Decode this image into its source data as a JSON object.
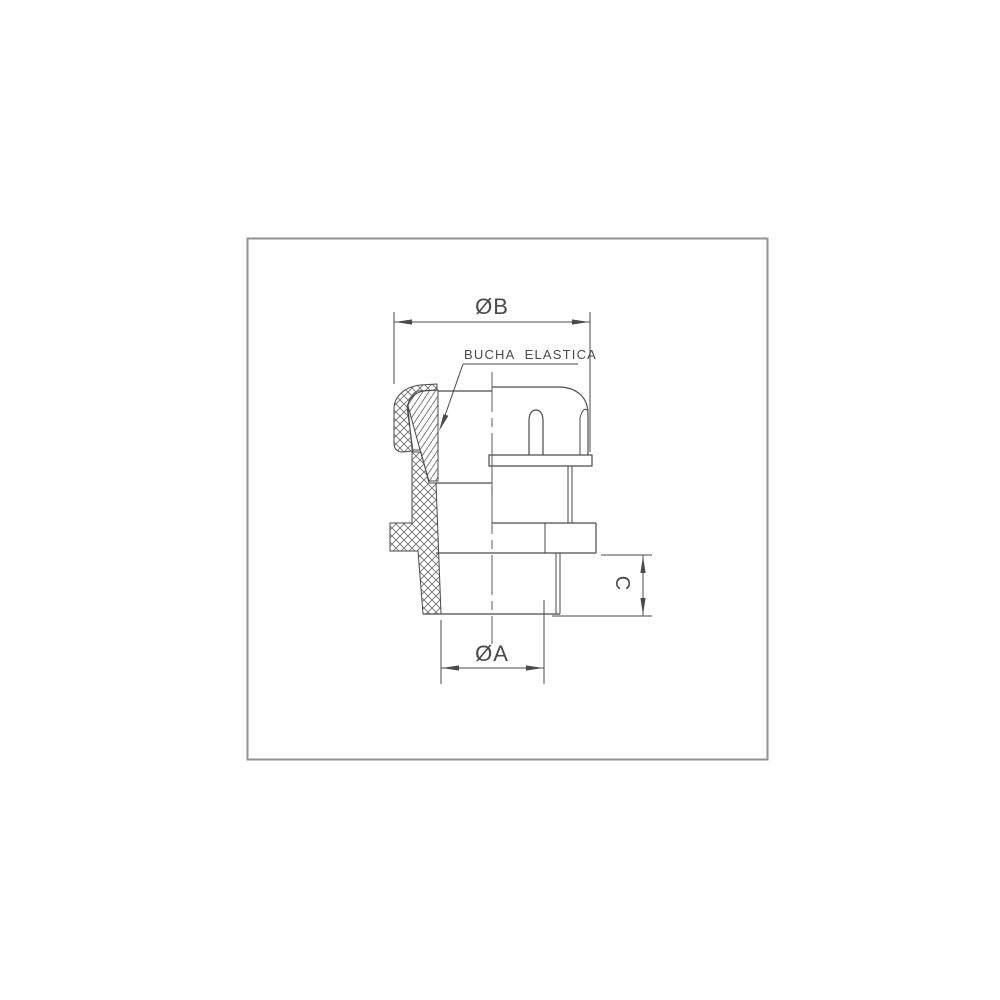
{
  "page": {
    "background": "#ffffff",
    "frame_color": "#929292"
  },
  "drawing": {
    "type": "technical-section-drawing",
    "subject": "cable gland cross-section",
    "line_color": "#4a4a4a",
    "hatch_color": "#6b6b6b",
    "labels": {
      "bushing": "BUCHA ELASTICA",
      "dim_diameter_b": "ØB",
      "dim_diameter_a": "ØA",
      "dim_height_c": "C"
    }
  }
}
